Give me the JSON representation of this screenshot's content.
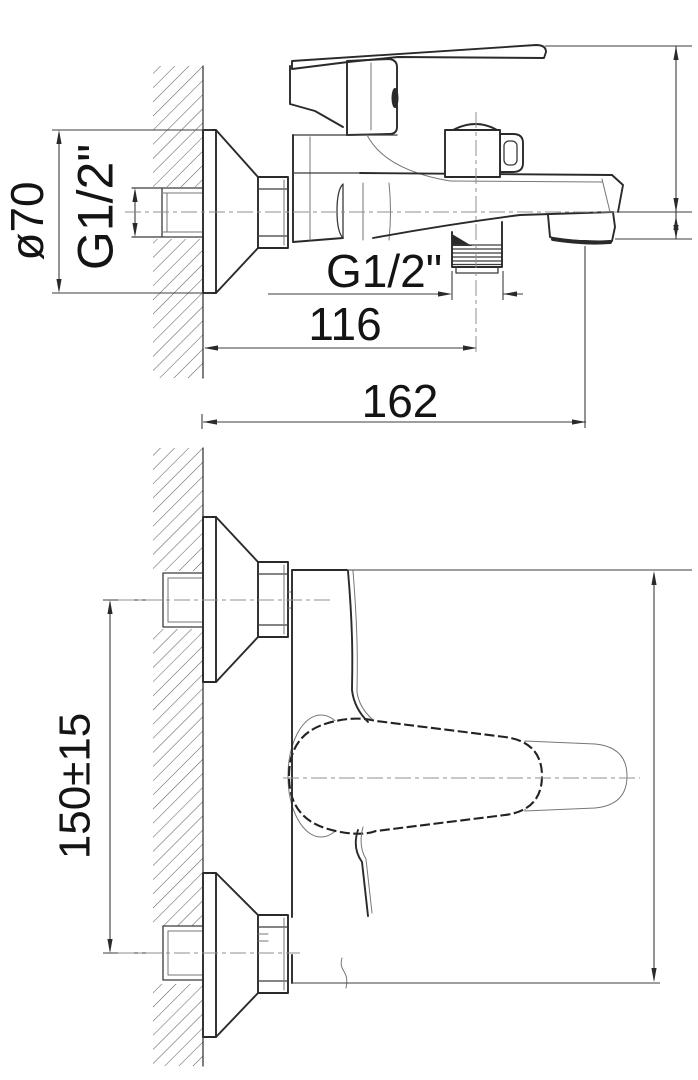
{
  "colors": {
    "background": "#ffffff",
    "ink": "#2a2a2a"
  },
  "views": {
    "side": {
      "labels": {
        "flange_diameter": "ø70",
        "wall_inlet_thread": "G1/2\"",
        "shower_outlet_thread": "G1/2\"",
        "wall_to_outlet_center": "116",
        "wall_to_spout_end": "162"
      }
    },
    "plan": {
      "labels": {
        "inlet_centers_spacing": "150±15"
      }
    }
  }
}
